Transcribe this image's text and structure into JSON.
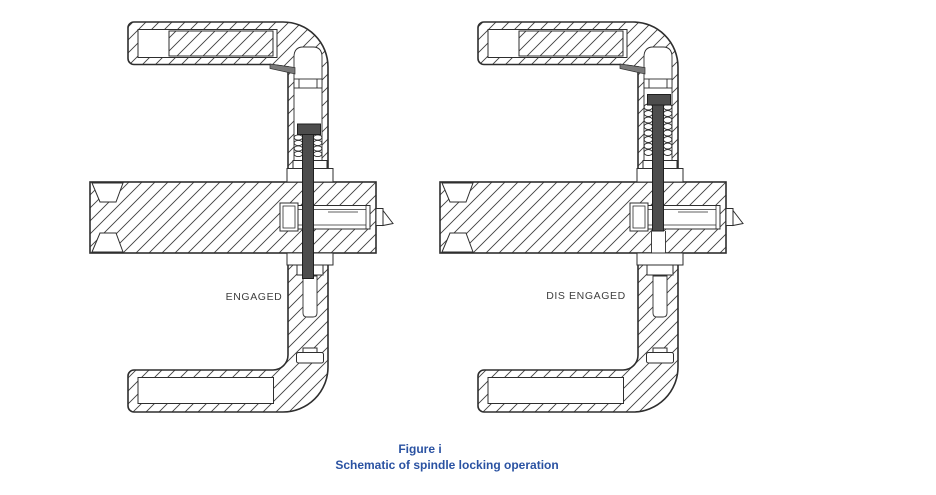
{
  "figure": {
    "views": [
      {
        "id": "engaged",
        "label": "ENGAGED"
      },
      {
        "id": "disengaged",
        "label": "DIS ENGAGED"
      }
    ],
    "caption": {
      "line1": "Figure i",
      "line2": "Schematic of spindle locking operation",
      "color": "#2a52a2"
    },
    "line_color": "#2e2e2e",
    "hatch_color": "#3f3f3f",
    "pin_color": "#4d4d4d",
    "label_color": "#3e3e3e"
  }
}
